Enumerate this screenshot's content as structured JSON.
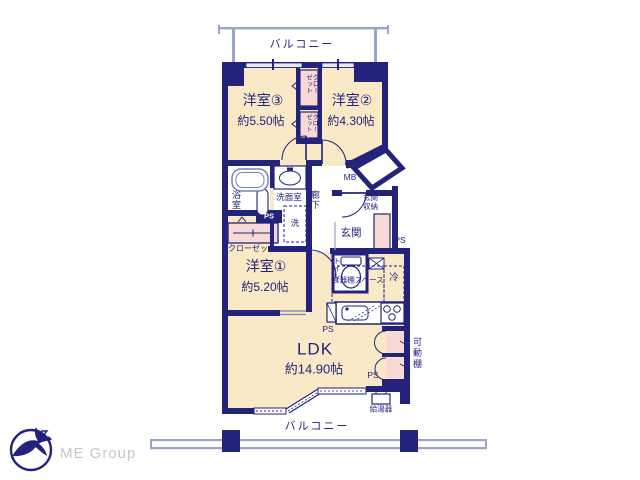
{
  "palette": {
    "wall": "#23237b",
    "floor_cream": "#f9e9c6",
    "closet_pink": "#f8d9d6",
    "window_blue": "#9aa4cc",
    "fixture_blue": "#7781b8",
    "text_navy": "#23237b",
    "logo_gray": "#c6c6c6"
  },
  "branding": {
    "company": "ME Group"
  },
  "plan": {
    "balcony_top": "バルコニー",
    "balcony_bottom": "バルコニー",
    "rooms": {
      "west3": {
        "name": "洋室③",
        "size": "約5.50帖"
      },
      "west2": {
        "name": "洋室②",
        "size": "約4.30帖"
      },
      "west1": {
        "name": "洋室①",
        "size": "約5.20帖"
      },
      "ldk": {
        "name": "LDK",
        "size": "約14.90帖"
      }
    },
    "labels": {
      "closet": "クローゼット",
      "bath": "浴室",
      "washroom": "洗面室",
      "laundry": "洗",
      "hallway": "廊下",
      "meter_box": "MB",
      "entrance": "玄関",
      "entrance_storage": "玄関収納",
      "toilet": "トイレ",
      "pipe_space": "PS",
      "cupboard_space": "食器棚スペース",
      "refrigerator": "冷",
      "movable_shelf": "可動棚",
      "water_heater": "給湯器"
    }
  }
}
